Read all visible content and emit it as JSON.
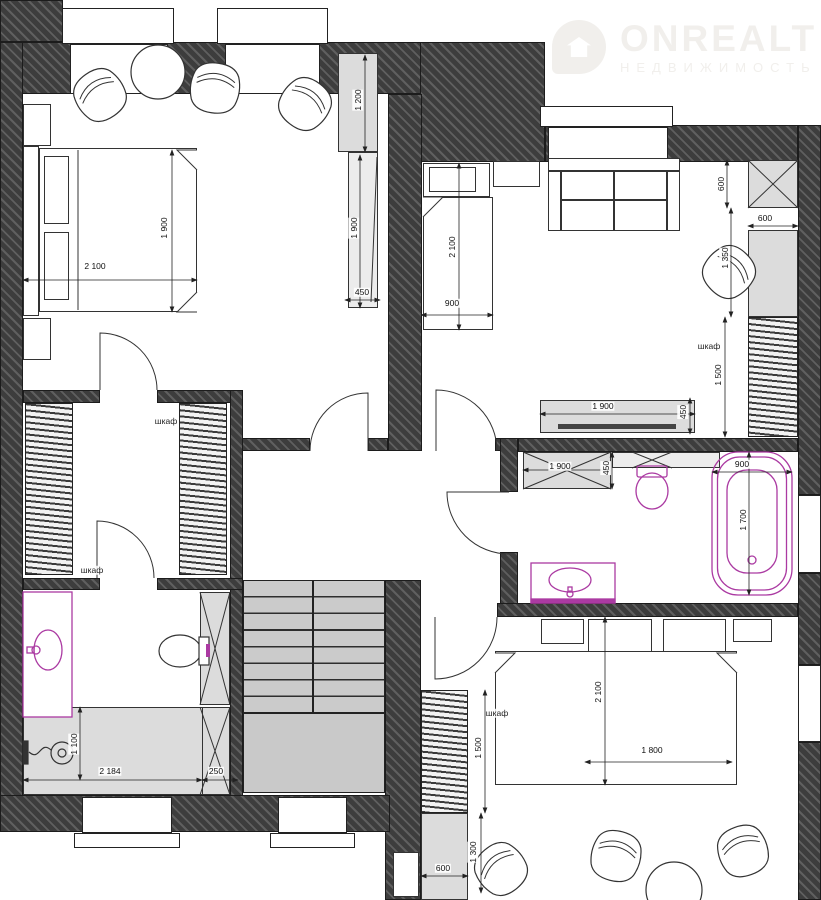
{
  "watermark": {
    "brand": "ONREALT",
    "sub": "НЕДВИЖИМОСТЬ"
  },
  "labels": {
    "wardrobe": "шкаф"
  },
  "dims": [
    "2 100",
    "1 900",
    "1 200",
    "1 900",
    "450",
    "2 100",
    "900",
    "600",
    "600",
    "1 350",
    "1 500",
    "1 900",
    "450",
    "1 900",
    "450",
    "900",
    "1 700",
    "1 500",
    "600",
    "1 300",
    "2 100",
    "1 800",
    "2 184",
    "250",
    "1 100"
  ],
  "colors": {
    "wall": "#3d3d3d",
    "wall_stripe": "#5f5f5f",
    "fixture_accent": "#ab3aa2",
    "furniture_fill": "#dcdcdc",
    "stairs_fill": "#cbcbcb",
    "line": "#222222",
    "watermark": "#f1efec"
  }
}
